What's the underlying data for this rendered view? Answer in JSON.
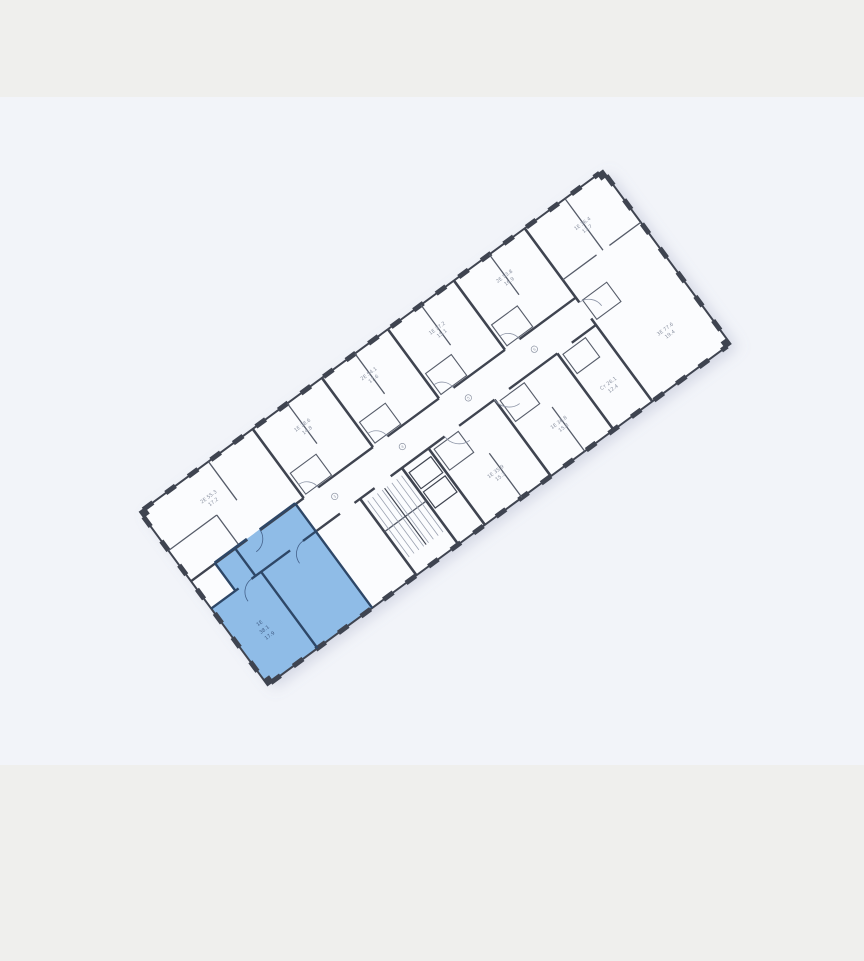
{
  "viewer": {
    "frame_color": "#efefed",
    "canvas_color": "#f2f4f9",
    "title": "floor-plan"
  },
  "floorplan": {
    "paper_color": "#fbfcfe",
    "wall_color": "#3f4450",
    "partition_color": "#565c69",
    "label_color": "#8d94a3",
    "hatch_color": "#9aa1b0",
    "door_color": "#8b93a5",
    "highlight": {
      "fill": "#8fbce7",
      "wall": "#2e4767",
      "label_color": "#44618a",
      "lines": [
        "1Е",
        "38.1",
        "17.9"
      ]
    },
    "room_labels": [
      {
        "l1": "2Е 55.3",
        "l2": "17.2"
      },
      {
        "l1": "1Е 38.6",
        "l2": "14.8"
      },
      {
        "l1": "2Е 54.1",
        "l2": "17.6"
      },
      {
        "l1": "1Е 37.2",
        "l2": "15.1"
      },
      {
        "l1": "2Е 53.8",
        "l2": "16.9"
      },
      {
        "l1": "1Е 36.4",
        "l2": "13.7"
      },
      {
        "l1": "3Е 77.6",
        "l2": "19.4"
      },
      {
        "l1": "1Е 35.9",
        "l2": "15.3"
      },
      {
        "l1": "1Е 36.8",
        "l2": "15.8"
      },
      {
        "l1": "Ст 26.1",
        "l2": "12.4"
      }
    ],
    "unit_badges": [
      "3",
      "4",
      "5",
      "6"
    ]
  }
}
